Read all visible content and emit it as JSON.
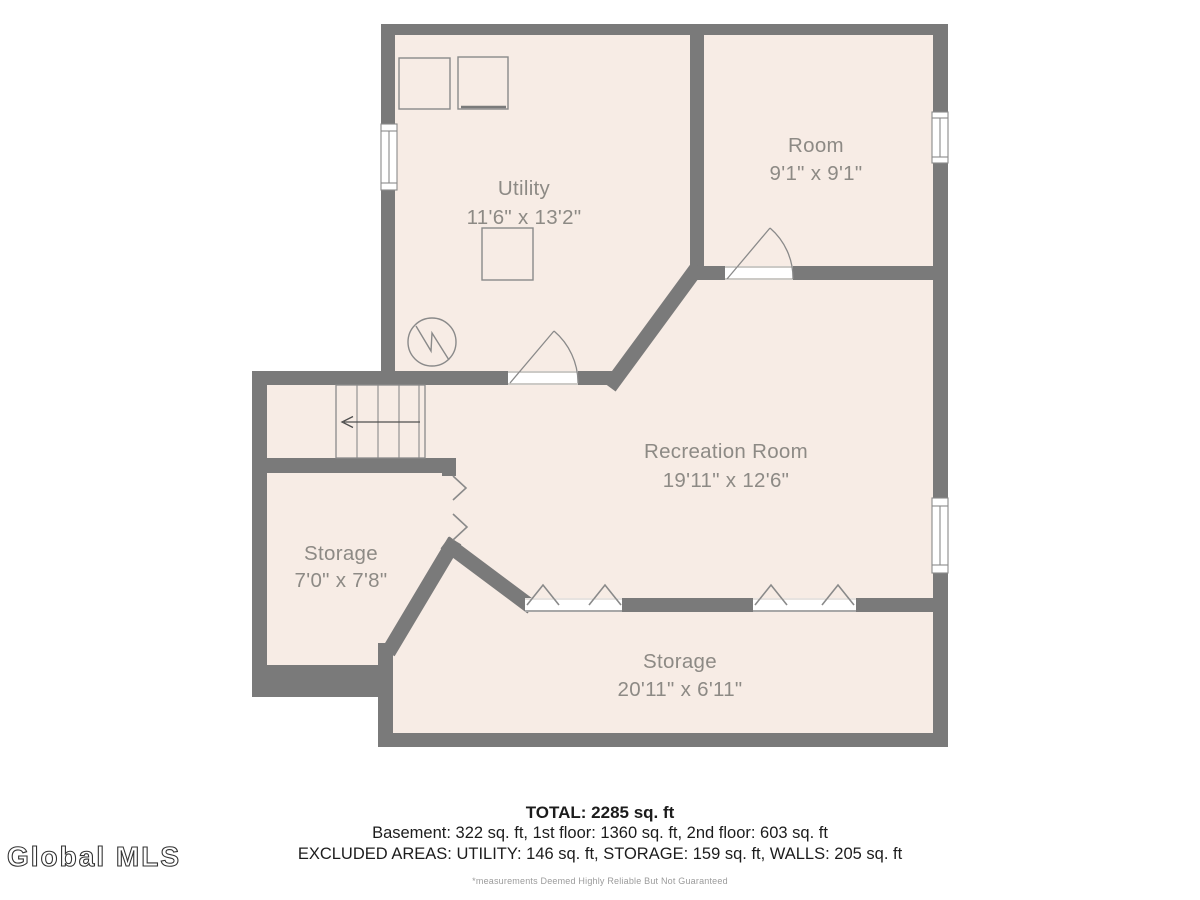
{
  "colors": {
    "wall": "#7a7a7a",
    "floor": "#f7ece5",
    "thin_line": "#8a8a8a",
    "room_label": "#8d8a85",
    "summary_text": "#1c1c1c",
    "disclaimer_text": "#9b9b9b"
  },
  "floorplan": {
    "level": "Basement",
    "rooms": [
      {
        "name": "Utility",
        "dims": "11'6\" x 13'2\""
      },
      {
        "name": "Room",
        "dims": "9'1\" x 9'1\""
      },
      {
        "name": "Recreation Room",
        "dims": "19'11\" x 12'6\""
      },
      {
        "name": "Storage",
        "dims": "7'0\" x 7'8\""
      },
      {
        "name": "Storage",
        "dims": "20'11\" x 6'11\""
      }
    ],
    "symbols": [
      "staircase-with-down-arrow",
      "sump-pump-circle",
      "appliance-squares",
      "door-swing-arcs",
      "window-symbols",
      "open-passage-chevrons"
    ]
  },
  "summary": {
    "total": "TOTAL: 2285 sq. ft",
    "floors": "Basement: 322 sq. ft, 1st floor: 1360 sq. ft, 2nd floor: 603 sq. ft",
    "excluded": "EXCLUDED AREAS: UTILITY: 146 sq. ft, STORAGE: 159 sq. ft, WALLS: 205 sq. ft",
    "disclaimer": "*measurements Deemed Highly Reliable But Not Guaranteed"
  },
  "watermark": {
    "text": "Global MLS"
  }
}
